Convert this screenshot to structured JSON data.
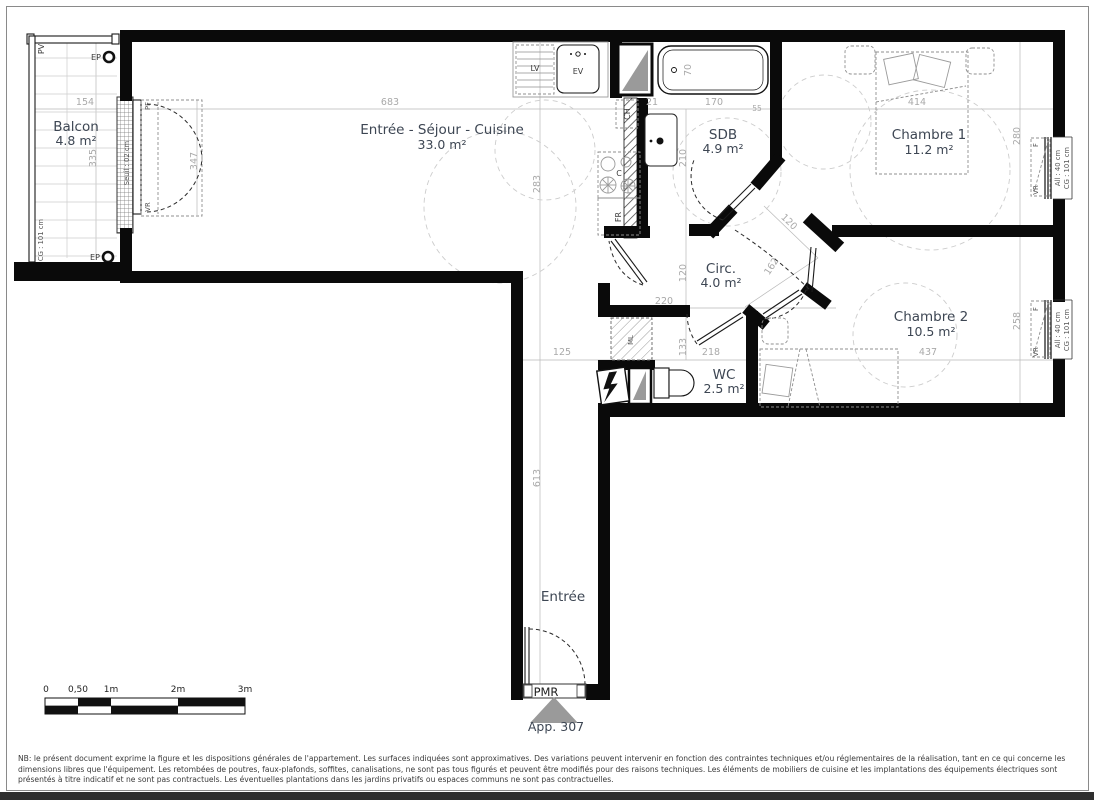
{
  "title": "Plan d'appartement App. 307",
  "rooms": {
    "balcon": {
      "name": "Balcon",
      "area": "4.8 m²"
    },
    "sejour": {
      "name": "Entrée - Séjour - Cuisine",
      "area": "33.0 m²"
    },
    "sdb": {
      "name": "SDB",
      "area": "4.9 m²"
    },
    "ch1": {
      "name": "Chambre 1",
      "area": "11.2 m²"
    },
    "circ": {
      "name": "Circ.",
      "area": "4.0 m²"
    },
    "ch2": {
      "name": "Chambre 2",
      "area": "10.5 m²"
    },
    "wc": {
      "name": "WC",
      "area": "2.5 m²"
    },
    "entree": {
      "name": "Entrée"
    }
  },
  "dims": {
    "living_w": "683",
    "living_h": "283",
    "balcony_w": "154",
    "balcony_h": "335",
    "balcony_door": "347",
    "k21": "21",
    "sdb_w": "170",
    "sdb_55": "55",
    "sdb_h": "210",
    "tub": "70",
    "ch1_w": "414",
    "ch1_h": "280",
    "circ_w": "220",
    "circ_door": "120",
    "circ_diag": "162",
    "circ_h": "120",
    "wc_h": "133",
    "wc_w": "218",
    "ch2_w": "437",
    "ch2_h": "258",
    "hall_w": "125",
    "hall_h": "613"
  },
  "labels": {
    "pv": "PV",
    "ep": "EP",
    "cg101": "CG : 101 cm",
    "seuil": "Seuil : 02 cm",
    "pf": "PF",
    "vr": "VR",
    "f": "F",
    "all40": "All : 40 cm",
    "lv": "LV",
    "ev": "EV",
    "ch": "CH",
    "c": "C",
    "fr": "FR",
    "ml": "ML",
    "pmr": "PMR",
    "app": "App. 307"
  },
  "scalebar": {
    "ticks": [
      "0",
      "0,50",
      "1m",
      "2m",
      "3m"
    ]
  },
  "disclaimer": "NB: le présent document exprime la figure et les dispositions générales de l'appartement. Les surfaces indiquées sont approximatives. Des variations peuvent intervenir en fonction des contraintes techniques et/ou réglementaires de la réalisation, tant en ce qui concerne les dimensions libres que l'équipement. Les retombées de poutres, faux-plafonds, soffites, canalisations, ne sont pas tous figurés et peuvent être modifiés pour des raisons techniques. Les éléments de mobiliers de cuisine et les implantations des équipements électriques sont présentés à titre indicatif et ne sont pas contractuels. Les éventuelles plantations dans les jardins privatifs ou espaces communs ne sont pas contractuelles.",
  "colors": {
    "wall": "#0a0a0a",
    "dim_text": "#a9a9a9",
    "room_text": "#3d4653",
    "shaft_gray": "#9a9a9a"
  }
}
